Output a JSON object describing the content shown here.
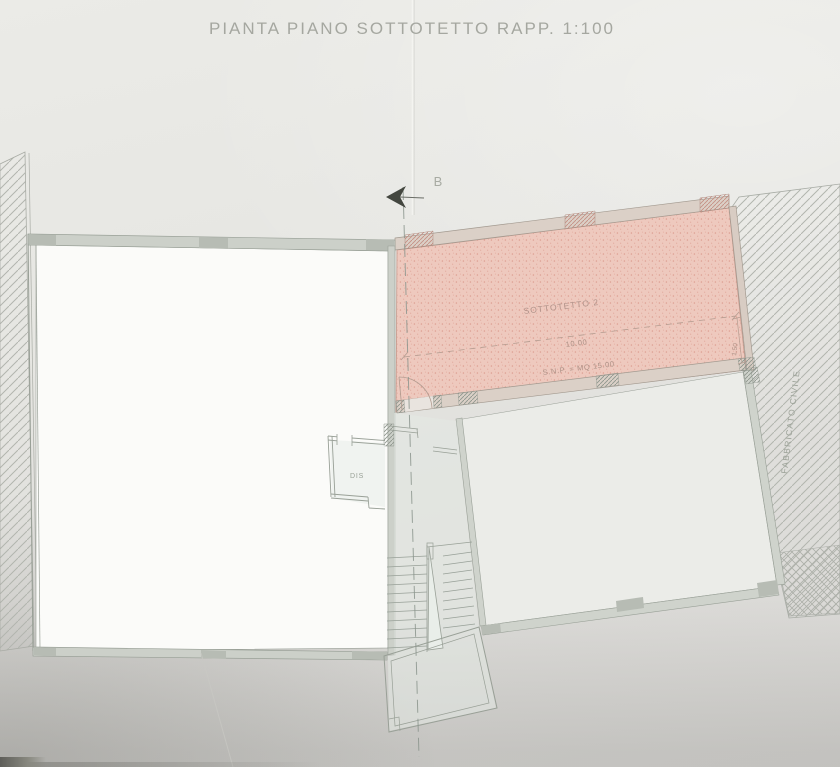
{
  "title": "PIANTA PIANO SOTTOTETTO RAPP. 1:100",
  "drawing": {
    "plan_name": "PIANTA PIANO SOTTOTETTO",
    "scale": "1:100"
  },
  "section": {
    "label": "B"
  },
  "rooms": {
    "sottotetto": {
      "label": "SOTTOTETTO 2",
      "width_dim": "10.00",
      "area_label": "S.N.P. = MQ 15.00",
      "height_dim": "1.50",
      "highlight_color": "#eec9be"
    },
    "dis": {
      "label": "DIS"
    }
  },
  "annotations": {
    "adjacent_building": "FABBRICATO CIVILE"
  },
  "colors": {
    "paper": "#e4e4e0",
    "highlight_fill": "#eec9be",
    "highlight_dots": "#dd9f93",
    "wall_fill": "#ccd0c9",
    "pillar_fill": "#b7bcb4",
    "line": "#99a097",
    "hatch": "#b4b7b0",
    "section_arrow": "#43463f",
    "annotation_text": "#9aa096",
    "pink_text": "#ab8f84"
  }
}
